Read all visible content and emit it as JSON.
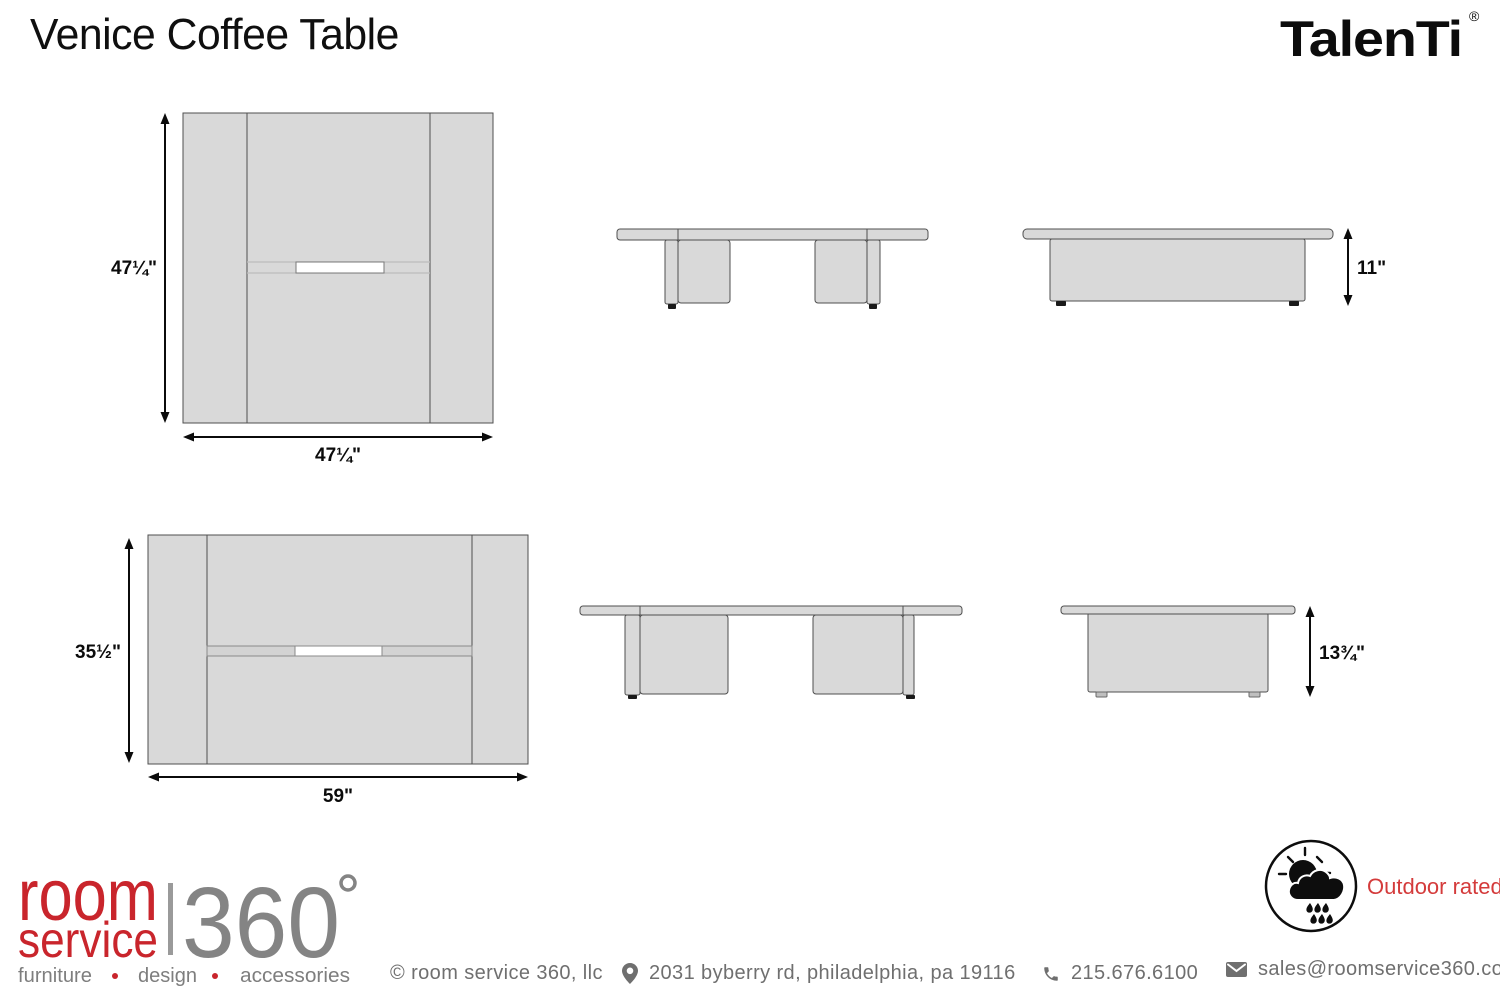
{
  "header": {
    "title": "Venice Coffee Table",
    "brand": "TalenTi",
    "brand_registered": "®"
  },
  "drawings": {
    "square_table": {
      "plan_width": "47¼\"",
      "plan_depth": "47¼\"",
      "height": "11\""
    },
    "rectangular_table": {
      "plan_width": "59\"",
      "plan_depth": "35½\"",
      "height": "13¾\""
    }
  },
  "badge": {
    "label": "Outdoor rated"
  },
  "logo": {
    "word1": "room",
    "word2": "service",
    "number": "360",
    "degree": "°",
    "tagline": [
      "furniture",
      "design",
      "accessories"
    ]
  },
  "footer": {
    "copyright": "© room service 360, llc",
    "address": "2031 byberry rd, philadelphia, pa 19116",
    "phone": "215.676.6100",
    "email": "sales@roomservice360.com"
  }
}
